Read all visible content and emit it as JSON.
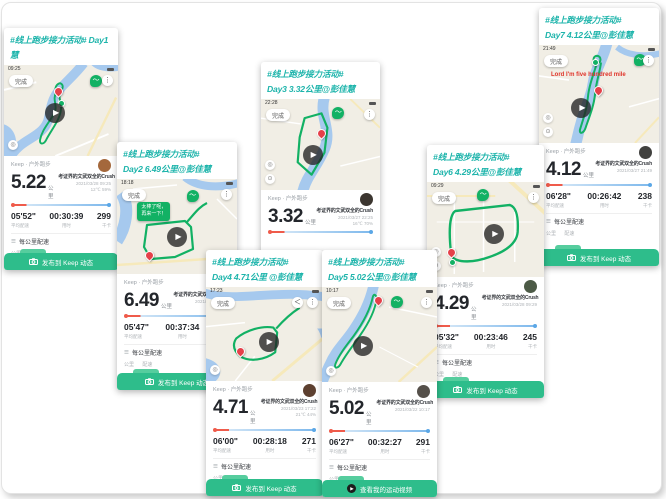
{
  "colors": {
    "accent_green": "#2ebd8b",
    "caption_teal": "#1db4ab",
    "route_green": "#12b164",
    "pin_red": "#e5404a"
  },
  "icons": {
    "more": "⋮",
    "share": "＜",
    "list": "☰",
    "play": "▶",
    "wave": "〜",
    "locate": "◎",
    "compass": "⊙"
  },
  "shared": {
    "app_label": "Keep · 户外跑步",
    "nickname": "考证界的文武双全的Crush",
    "km_unit": "公里",
    "done_label": "完成",
    "stat_labels": {
      "pace": "平均配速",
      "duration": "用时",
      "calories": "千卡"
    },
    "per_km_title": "每公里配速",
    "per_km_columns": "公里      配速"
  },
  "cards": [
    {
      "id": "day1",
      "header_line1": "#线上跑步接力活动# Day1",
      "header_line2": "慧",
      "status_time": "09:25",
      "distance": "5.22",
      "datetime": "2021/03/28 09:25",
      "weather": "12℃  59%",
      "pace": "05'52\"",
      "duration": "00:30:39",
      "calories": "299",
      "bottom_label": "发布到 Keep 动态"
    },
    {
      "id": "day2",
      "header_line1": "#线上跑步接力活动#",
      "header_line2": "Day2 6.49公里@彭佳慧",
      "status_time": "18:18",
      "tooltip_line1": "太棒了呢，",
      "tooltip_line2": "再来一下！",
      "distance": "6.49",
      "datetime": "2021/03/28 18:12",
      "weather": "28℃  38%",
      "pace": "05'47\"",
      "duration": "00:37:34",
      "calories": "372",
      "bottom_label": "发布到 Keep 动态"
    },
    {
      "id": "day3",
      "header_line1": "#线上跑步接力活动#",
      "header_line2": "Day3  3.32公里@彭佳慧",
      "status_time": "22:28",
      "distance": "3.32",
      "datetime": "2021/03/27 22:25",
      "weather": "16℃  70%",
      "pace": "",
      "duration": "",
      "calories": "",
      "bottom_label": ""
    },
    {
      "id": "day4",
      "header_line1": "#线上跑步接力活动#",
      "header_line2": "Day4 4.71公里 @彭佳慧",
      "status_time": "17:23",
      "distance": "4.71",
      "datetime": "2021/03/23 17:22",
      "weather": "21℃  44%",
      "pace": "06'00\"",
      "duration": "00:28:18",
      "calories": "271",
      "bottom_label": "发布到 Keep 动态"
    },
    {
      "id": "day5",
      "header_line1": "#线上跑步接力活动#",
      "header_line2": "Day5  5.02公里@彭佳慧",
      "status_time": "10:17",
      "distance": "5.02",
      "datetime": "2021/03/22 10:17",
      "weather": "",
      "pace": "06'27\"",
      "duration": "00:32:27",
      "calories": "291",
      "bottom_label": "查看我的运动视频"
    },
    {
      "id": "day6",
      "header_line1": "#线上跑步接力活动#",
      "header_line2": "Day6  4.29公里@彭佳慧",
      "status_time": "09:29",
      "distance": "4.29",
      "datetime": "2021/03/28 09:29",
      "weather": "",
      "pace": "05'32\"",
      "duration": "00:23:46",
      "calories": "245",
      "bottom_label": "发布到 Keep 动态"
    },
    {
      "id": "day7",
      "header_line1": "#线上跑步接力活动#",
      "header_line2": "Day7 4.12公里@彭佳慧",
      "status_time": "21:49",
      "red_note": "Lord I'm five hundred mile",
      "distance": "4.12",
      "datetime": "2021/03/27 21:49",
      "weather": "",
      "pace": "06'28\"",
      "duration": "00:26:42",
      "calories": "238",
      "bottom_label": "发布到 Keep 动态"
    }
  ]
}
